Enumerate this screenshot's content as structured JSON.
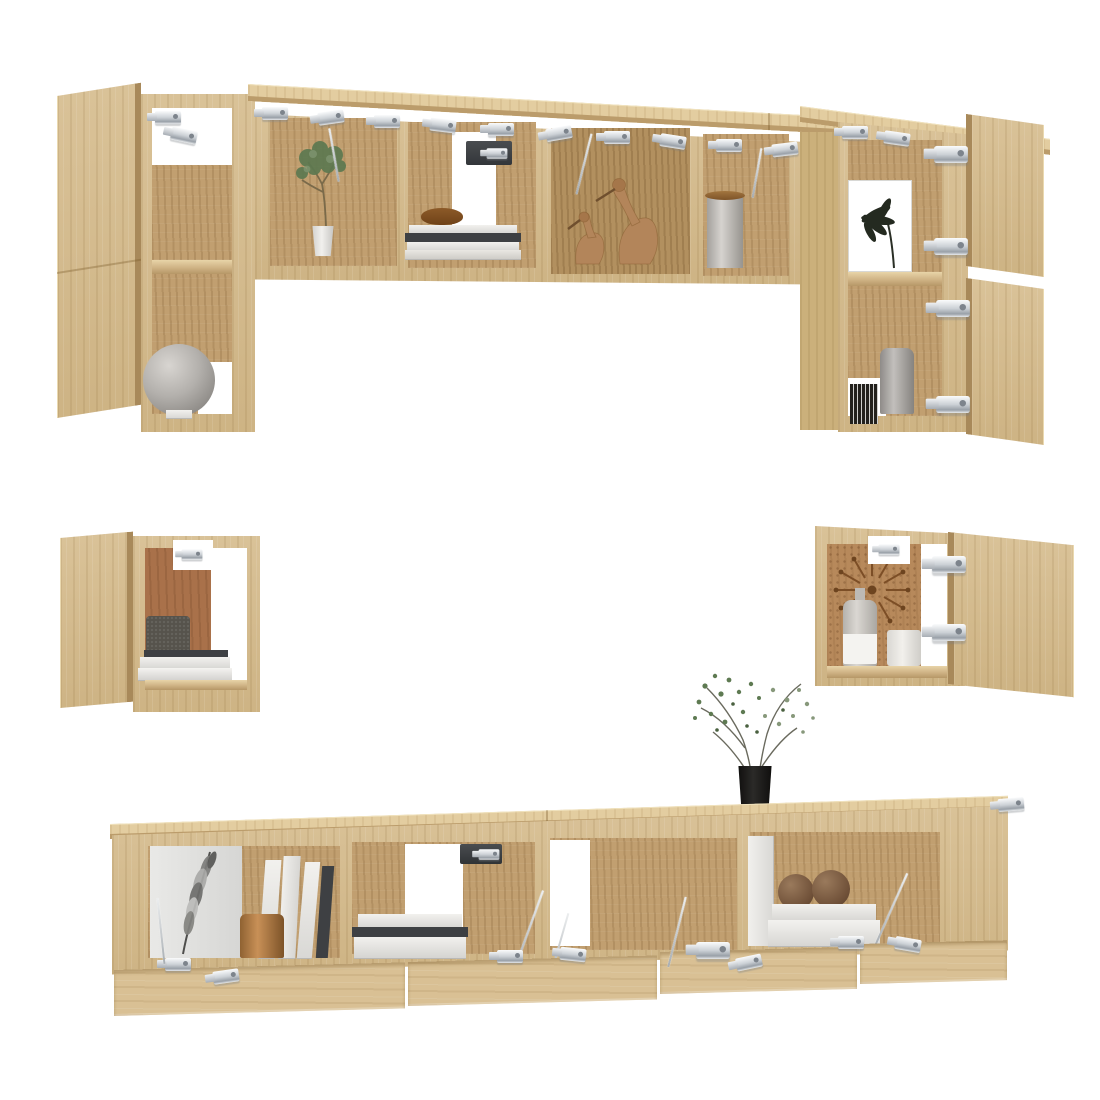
{
  "meta": {
    "type": "product-photo",
    "subject": "7-piece TV wall cabinet set in sonoma oak with open doors, silver hinges and decor props",
    "background_color": "#ffffff",
    "visible_text": "none"
  },
  "palette": {
    "oak_face": "#d5bb8c",
    "oak_top": "#e3cda0",
    "oak_interior": "#c19f70",
    "oak_deep": "#b2905f",
    "oak_edge": "#a8895a",
    "terracotta_back": "#a9714a",
    "cork_back": "#b7895b",
    "metal_silver": "#ccd1d6",
    "globe_gray": "#b3b0ac",
    "vase_gray": "#9b9895",
    "copper": "#b07c44",
    "bronze_sphere": "#6f5038",
    "plant_green": "#5d7950",
    "leaf_art_dark": "#242a20",
    "pot_black": "#171614",
    "book_white": "#eceae7",
    "book_dark": "#3e4043"
  },
  "top_wall_unit": {
    "left_tall_cabinet": {
      "title": "Tall wall cabinet with open door",
      "props": [
        "open-door",
        "metal-hinges",
        "gray-globe-on-white-base"
      ]
    },
    "shelf_row": {
      "title": "Wall shelf row with open flap doors",
      "compartments": [
        {
          "name": "compartment-plant",
          "props": [
            "green-plant-in-white-pot"
          ]
        },
        {
          "name": "compartment-books",
          "props": [
            "white-book-stack",
            "wooden-bowl",
            "fold-down-bracket"
          ]
        },
        {
          "name": "compartment-ducks",
          "props": [
            "two-wooden-duck-figurines"
          ]
        },
        {
          "name": "compartment-canister",
          "props": [
            "gray-canister-with-wood-lid"
          ]
        }
      ],
      "hardware": [
        "row-of-silver-flap-hinges",
        "lift-struts"
      ]
    },
    "right_tall_cabinet": {
      "title": "Tall wall cabinet with two doors open right",
      "props": [
        "palm-leaf-artwork",
        "gray-vase",
        "dark-striped-books",
        "two-open-doors",
        "metal-hinges"
      ]
    }
  },
  "left_wall_cube": {
    "title": "Small wall cube, door open left",
    "props": [
      "open-door",
      "terracotta-back-panel",
      "hinge-block",
      "dark-box",
      "white-book-stack"
    ]
  },
  "right_wall_cube": {
    "title": "Small wall cube, door open right",
    "props": [
      "open-door",
      "starburst-wall-clock",
      "glass-bottle-with-label",
      "white-candle",
      "metal-hinges"
    ]
  },
  "tv_stand": {
    "title": "Low TV stand with four flap doors open downward",
    "top_prop": "wispy-plant-in-black-pot",
    "compartments": [
      {
        "name": "compartment-feather",
        "props": [
          "feather-artwork",
          "upright-white-books",
          "dark-book",
          "copper-vase"
        ]
      },
      {
        "name": "compartment-binder",
        "props": [
          "white-binder-stack",
          "fold-down-bracket"
        ]
      },
      {
        "name": "compartment-open",
        "props": [
          "lift-struts",
          "metal-hinges"
        ]
      },
      {
        "name": "compartment-spheres",
        "props": [
          "white-door-panel",
          "two-bronze-spheres",
          "white-book-stack",
          "lift-strut"
        ]
      }
    ],
    "open_flap_doors": 4,
    "hardware": [
      "silver-flap-hinges",
      "lift-struts"
    ]
  }
}
